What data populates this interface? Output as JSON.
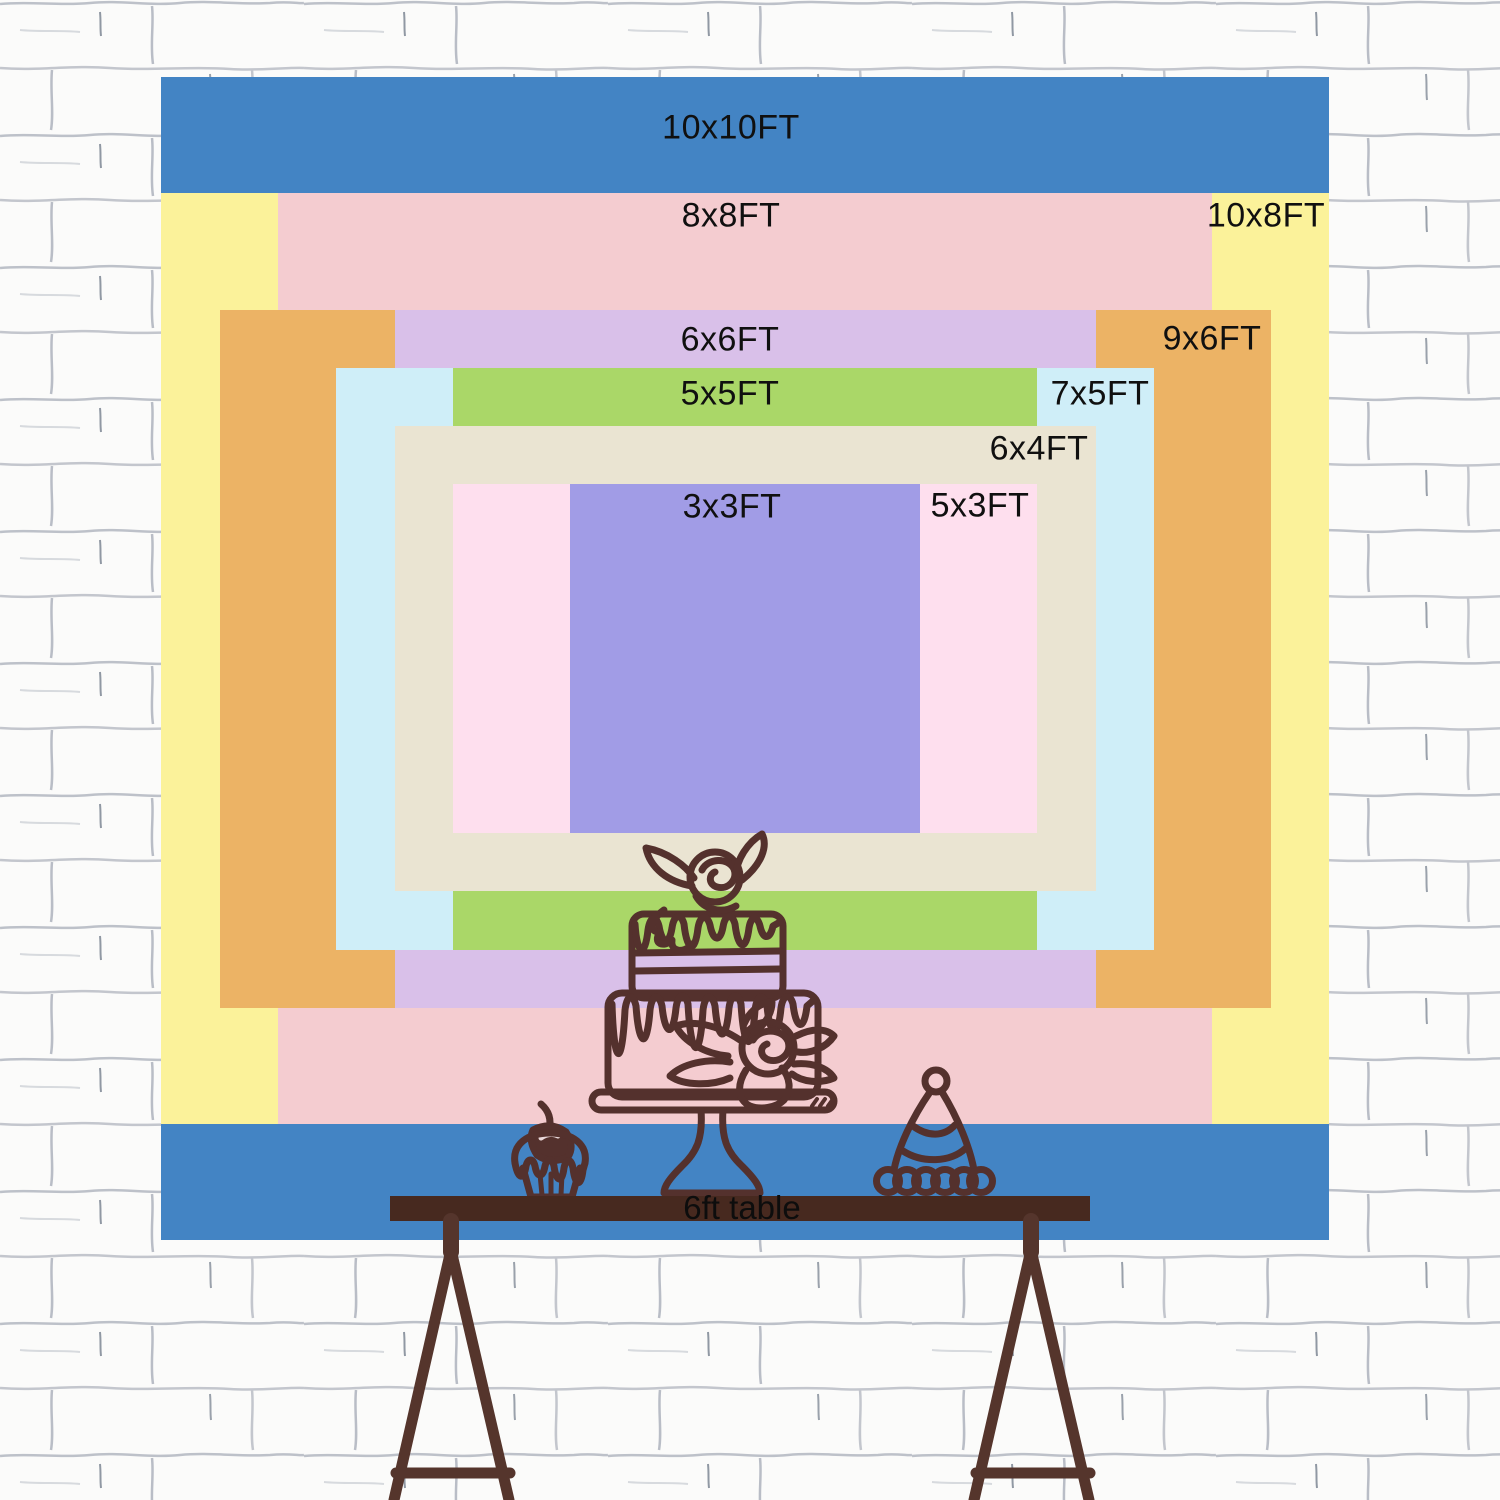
{
  "backdrop": {
    "sizes": [
      {
        "label": "10x10FT",
        "width_ft": 10,
        "height_ft": 10,
        "color": "#4384c4"
      },
      {
        "label": "10x8FT",
        "width_ft": 10,
        "height_ft": 8,
        "color": "#fbf29a"
      },
      {
        "label": "8x8FT",
        "width_ft": 8,
        "height_ft": 8,
        "color": "#f4ccd0"
      },
      {
        "label": "9x6FT",
        "width_ft": 9,
        "height_ft": 6,
        "color": "#ecb365"
      },
      {
        "label": "6x6FT",
        "width_ft": 6,
        "height_ft": 6,
        "color": "#d9c0e9"
      },
      {
        "label": "7x5FT",
        "width_ft": 7,
        "height_ft": 5,
        "color": "#cfeef8"
      },
      {
        "label": "5x5FT",
        "width_ft": 5,
        "height_ft": 5,
        "color": "#aad768"
      },
      {
        "label": "6x4FT",
        "width_ft": 6,
        "height_ft": 4,
        "color": "#eae4d2"
      },
      {
        "label": "5x3FT",
        "width_ft": 5,
        "height_ft": 3,
        "color": "#fedfee"
      },
      {
        "label": "3x3FT",
        "width_ft": 3,
        "height_ft": 3,
        "color": "#a19ce6"
      }
    ]
  },
  "table": {
    "label": "6ft table",
    "bar_color": "#47291f",
    "leg_color": "#55352c"
  },
  "illustrations": {
    "line_color": "#54312d",
    "items": [
      "two-tier-drip-cake-on-stand",
      "cupcake-with-cherry",
      "party-hat"
    ]
  },
  "background": {
    "wall_color": "#fbfbfa",
    "mortar_line_color": "#bdc1c9"
  }
}
